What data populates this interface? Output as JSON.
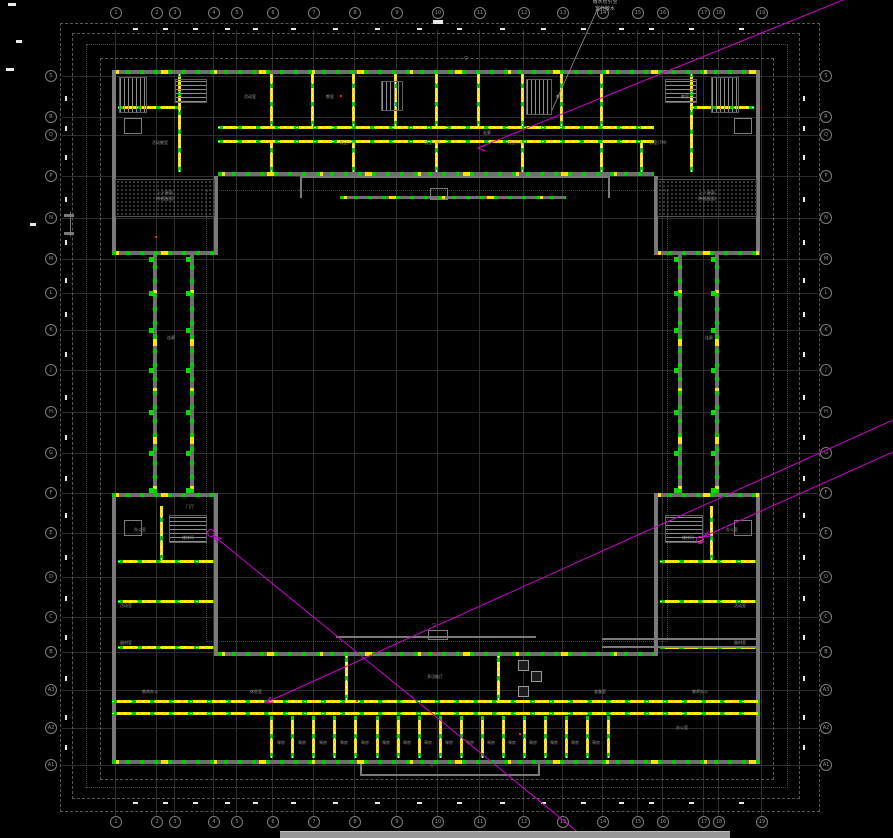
{
  "app": {
    "background": "#000000"
  },
  "colors": {
    "wall": "#7a7a7a",
    "highlight_green": "#00cc00",
    "highlight_yellow": "#ffe400",
    "magenta": "#cf00cf",
    "grid": "#2e2e2e",
    "dim_text": "#e9e9e9",
    "label": "#9a9a9a"
  },
  "bar": {
    "x": 280,
    "y": 831,
    "w": 450,
    "h": 7
  },
  "annotation": {
    "lines": [
      [
        605,
        0,
        "雨水管引至"
      ],
      [
        605,
        7,
        "室外散水"
      ]
    ],
    "leader": [
      597,
      10,
      552,
      110
    ]
  },
  "plan": {
    "grid": {
      "top": 30,
      "bottom": 816,
      "left": 62,
      "right": 818,
      "bub_top": 13,
      "bub_bottom": 822,
      "bub_left": 50,
      "bub_right": 825,
      "cols": [
        {
          "x": 115,
          "l": "1"
        },
        {
          "x": 156,
          "l": "2"
        },
        {
          "x": 174,
          "l": "3"
        },
        {
          "x": 213,
          "l": "4"
        },
        {
          "x": 236,
          "l": "5"
        },
        {
          "x": 272,
          "l": "6"
        },
        {
          "x": 313,
          "l": "7"
        },
        {
          "x": 354,
          "l": "8"
        },
        {
          "x": 396,
          "l": "9"
        },
        {
          "x": 437,
          "l": "10"
        },
        {
          "x": 479,
          "l": "11"
        },
        {
          "x": 523,
          "l": "12"
        },
        {
          "x": 562,
          "l": "13"
        },
        {
          "x": 602,
          "l": "14"
        },
        {
          "x": 637,
          "l": "15"
        },
        {
          "x": 662,
          "l": "16"
        },
        {
          "x": 703,
          "l": "17"
        },
        {
          "x": 718,
          "l": "18"
        },
        {
          "x": 761,
          "l": "19"
        }
      ],
      "rows": [
        {
          "y": 76,
          "l": "S"
        },
        {
          "y": 117,
          "l": "R"
        },
        {
          "y": 135,
          "l": "Q"
        },
        {
          "y": 176,
          "l": "P"
        },
        {
          "y": 218,
          "l": "N"
        },
        {
          "y": 259,
          "l": "M"
        },
        {
          "y": 293,
          "l": "L"
        },
        {
          "y": 330,
          "l": "K"
        },
        {
          "y": 370,
          "l": "J"
        },
        {
          "y": 412,
          "l": "H"
        },
        {
          "y": 453,
          "l": "G"
        },
        {
          "y": 493,
          "l": "F"
        },
        {
          "y": 533,
          "l": "E"
        },
        {
          "y": 577,
          "l": "D"
        },
        {
          "y": 617,
          "l": "C"
        },
        {
          "y": 652,
          "l": "B"
        },
        {
          "y": 690,
          "l": "A3"
        },
        {
          "y": 728,
          "l": "A2"
        },
        {
          "y": 765,
          "l": "A1"
        }
      ]
    },
    "boundaries": [
      [
        "dash",
        60,
        23,
        758,
        787
      ],
      [
        "dash",
        72,
        33,
        726,
        764
      ],
      [
        "dot",
        86,
        44,
        700,
        742
      ],
      [
        "dash",
        100,
        58,
        672,
        720
      ],
      [
        "dot",
        206,
        190,
        460,
        450
      ]
    ],
    "walls": [
      [
        "wt",
        112,
        70,
        648,
        4
      ],
      [
        "w",
        112,
        70,
        4,
        185
      ],
      [
        "w",
        756,
        70,
        4,
        185
      ],
      [
        "hl",
        218,
        126,
        436,
        3
      ],
      [
        "hl",
        218,
        140,
        436,
        3
      ],
      [
        "wt",
        218,
        172,
        436,
        4
      ],
      [
        "wt",
        112,
        251,
        106,
        4
      ],
      [
        "wt",
        654,
        251,
        106,
        4
      ],
      [
        "w",
        214,
        176,
        4,
        79
      ],
      [
        "w",
        654,
        176,
        4,
        79
      ],
      [
        "hl",
        118,
        106,
        62,
        3
      ],
      [
        "hlv",
        178,
        74,
        3,
        98
      ],
      [
        "stv",
        120,
        78,
        26,
        34
      ],
      [
        "st",
        176,
        80,
        30,
        22
      ],
      [
        "hl",
        692,
        106,
        62,
        3
      ],
      [
        "hlv",
        690,
        74,
        3,
        98
      ],
      [
        "stv",
        712,
        78,
        26,
        34
      ],
      [
        "st",
        666,
        80,
        30,
        22
      ],
      [
        "hlv",
        270,
        74,
        3,
        52
      ],
      [
        "hlv",
        311,
        74,
        3,
        52
      ],
      [
        "hlv",
        352,
        74,
        3,
        52
      ],
      [
        "hlv",
        394,
        74,
        3,
        52
      ],
      [
        "hlv",
        435,
        74,
        3,
        52
      ],
      [
        "hlv",
        477,
        74,
        3,
        52
      ],
      [
        "hlv",
        521,
        74,
        3,
        52
      ],
      [
        "hlv",
        560,
        74,
        3,
        52
      ],
      [
        "hlv",
        600,
        74,
        3,
        52
      ],
      [
        "stv",
        527,
        80,
        24,
        34
      ],
      [
        "stv",
        382,
        82,
        20,
        28
      ],
      [
        "hlv",
        270,
        143,
        3,
        29
      ],
      [
        "hlv",
        352,
        143,
        3,
        29
      ],
      [
        "hlv",
        435,
        143,
        3,
        29
      ],
      [
        "hlv",
        521,
        143,
        3,
        29
      ],
      [
        "hlv",
        600,
        143,
        3,
        29
      ],
      [
        "hlv",
        640,
        143,
        3,
        29
      ],
      [
        "w",
        300,
        176,
        310,
        2
      ],
      [
        "wt",
        340,
        196,
        226,
        3
      ],
      [
        "w",
        300,
        176,
        2,
        22
      ],
      [
        "w",
        608,
        176,
        2,
        22
      ],
      [
        "bx",
        430,
        188,
        16,
        10
      ],
      [
        "ht",
        116,
        180,
        98,
        36
      ],
      [
        "ht",
        658,
        180,
        98,
        36
      ],
      [
        "wtv",
        153,
        255,
        4,
        238
      ],
      [
        "wtv",
        190,
        255,
        4,
        238
      ],
      [
        "wtv",
        678,
        255,
        4,
        238
      ],
      [
        "wtv",
        715,
        255,
        4,
        238
      ],
      [
        "w",
        112,
        493,
        4,
        271
      ],
      [
        "w",
        756,
        493,
        4,
        271
      ],
      [
        "wt",
        112,
        493,
        106,
        4
      ],
      [
        "wt",
        654,
        493,
        106,
        4
      ],
      [
        "w",
        214,
        493,
        4,
        163
      ],
      [
        "w",
        654,
        493,
        4,
        163
      ],
      [
        "hl",
        118,
        560,
        96,
        3
      ],
      [
        "hl",
        118,
        600,
        96,
        3
      ],
      [
        "hl",
        118,
        646,
        96,
        3
      ],
      [
        "hlv",
        160,
        506,
        3,
        54
      ],
      [
        "st",
        170,
        516,
        36,
        26
      ],
      [
        "bx",
        124,
        520,
        16,
        14
      ],
      [
        "hl",
        660,
        560,
        96,
        3
      ],
      [
        "hl",
        660,
        600,
        96,
        3
      ],
      [
        "hl",
        660,
        646,
        96,
        3
      ],
      [
        "hlv",
        710,
        506,
        3,
        54
      ],
      [
        "st",
        666,
        516,
        36,
        26
      ],
      [
        "bx",
        734,
        520,
        16,
        14
      ],
      [
        "wt",
        218,
        652,
        436,
        4
      ],
      [
        "hl",
        112,
        700,
        648,
        3
      ],
      [
        "hl",
        112,
        712,
        648,
        3
      ],
      [
        "wt",
        112,
        760,
        648,
        4
      ],
      [
        "hlv",
        345,
        656,
        3,
        44
      ],
      [
        "hlv",
        497,
        656,
        3,
        44
      ],
      [
        "w",
        602,
        638,
        154,
        2
      ],
      [
        "w",
        602,
        646,
        154,
        2
      ],
      [
        "w",
        336,
        636,
        200,
        2
      ],
      [
        "bx",
        428,
        630,
        18,
        8
      ],
      [
        "w",
        360,
        764,
        2,
        12
      ],
      [
        "w",
        538,
        764,
        2,
        12
      ],
      [
        "w",
        360,
        774,
        180,
        2
      ],
      [
        "bx",
        124,
        118,
        16,
        14
      ],
      [
        "bx",
        734,
        118,
        16,
        14
      ],
      [
        "w",
        64,
        214,
        10,
        3
      ],
      [
        "w",
        64,
        232,
        10,
        3
      ],
      [
        "w",
        70,
        212,
        1,
        24
      ],
      [
        "hlv",
        270,
        716,
        3,
        42
      ],
      [
        "hlv",
        291,
        716,
        3,
        42
      ],
      [
        "hlv",
        312,
        716,
        3,
        42
      ],
      [
        "hlv",
        333,
        716,
        3,
        42
      ],
      [
        "hlv",
        354,
        716,
        3,
        42
      ],
      [
        "hlv",
        376,
        716,
        3,
        42
      ],
      [
        "hlv",
        397,
        716,
        3,
        42
      ],
      [
        "hlv",
        418,
        716,
        3,
        42
      ],
      [
        "hlv",
        439,
        716,
        3,
        42
      ],
      [
        "hlv",
        460,
        716,
        3,
        42
      ],
      [
        "hlv",
        481,
        716,
        3,
        42
      ],
      [
        "hlv",
        502,
        716,
        3,
        42
      ],
      [
        "hlv",
        523,
        716,
        3,
        42
      ],
      [
        "hlv",
        544,
        716,
        3,
        42
      ],
      [
        "hlv",
        565,
        716,
        3,
        42
      ],
      [
        "hlv",
        586,
        716,
        3,
        42
      ],
      [
        "hlv",
        607,
        716,
        3,
        42
      ],
      [
        "pil",
        518,
        660,
        9,
        9
      ],
      [
        "pil",
        518,
        686,
        9,
        9
      ],
      [
        "pil",
        531,
        671,
        9,
        9
      ]
    ],
    "columns": {
      "xs": [
        151,
        188,
        676,
        713
      ],
      "ys": [
        259,
        293,
        330,
        370,
        412,
        453,
        490
      ]
    },
    "reds": [
      [
        155,
        236
      ],
      [
        356,
        700
      ],
      [
        519,
        733
      ],
      [
        340,
        95
      ],
      [
        700,
        540
      ],
      [
        434,
        652
      ]
    ],
    "labels": [
      [
        330,
        95,
        "教室"
      ],
      [
        250,
        95,
        "活动室"
      ],
      [
        560,
        95,
        "教室"
      ],
      [
        685,
        95,
        "教室"
      ],
      [
        348,
        141,
        "教室(7M)"
      ],
      [
        433,
        141,
        "教室(7M)"
      ],
      [
        516,
        141,
        "教室(7M)"
      ],
      [
        658,
        141,
        "教室(7M)"
      ],
      [
        160,
        141,
        "活动教室"
      ],
      [
        487,
        131,
        "走廊"
      ],
      [
        165,
        191,
        "上人屋面"
      ],
      [
        165,
        197,
        "(种植屋面)"
      ],
      [
        707,
        191,
        "上人屋面"
      ],
      [
        707,
        197,
        "(种植屋面)"
      ],
      [
        171,
        336,
        "连廊"
      ],
      [
        709,
        336,
        "连廊"
      ],
      [
        140,
        528,
        "办公室"
      ],
      [
        126,
        604,
        "活动室"
      ],
      [
        126,
        641,
        "器材室"
      ],
      [
        188,
        536,
        "楼梯间"
      ],
      [
        150,
        690,
        "教师办公"
      ],
      [
        190,
        505,
        "门厅"
      ],
      [
        732,
        528,
        "办公室"
      ],
      [
        740,
        604,
        "活动室"
      ],
      [
        740,
        641,
        "器材室"
      ],
      [
        688,
        536,
        "楼梯间"
      ],
      [
        700,
        690,
        "教师办公"
      ],
      [
        435,
        675,
        "多功能厅"
      ],
      [
        682,
        726,
        "办公室"
      ],
      [
        256,
        690,
        "休息室"
      ],
      [
        600,
        690,
        "准备室"
      ]
    ],
    "level_marks": [
      [
        466,
        57,
        "▽"
      ],
      [
        664,
        561,
        "▽"
      ],
      [
        434,
        624,
        "▽"
      ],
      [
        432,
        764,
        "▽"
      ]
    ],
    "repeat_labels": {
      "t": "琴房",
      "y": 741,
      "xs": [
        281,
        302,
        323,
        344,
        365,
        386,
        407,
        428,
        449,
        470,
        491,
        512,
        533,
        554,
        575,
        596
      ]
    },
    "dims": {
      "top": {
        "y": 28,
        "xs": [
          133,
          163,
          193,
          225,
          253,
          291,
          333,
          375,
          417,
          457,
          500,
          541,
          581,
          619,
          649,
          689,
          739
        ]
      },
      "bottom": {
        "y": 802,
        "xs": [
          133,
          163,
          193,
          225,
          253,
          291,
          333,
          375,
          417,
          457,
          500,
          541,
          581,
          619,
          649,
          689,
          739
        ]
      },
      "left": {
        "x": 65,
        "ys": [
          96,
          126,
          155,
          197,
          240,
          278,
          312,
          352,
          395,
          435,
          476,
          513,
          555,
          596,
          635,
          676,
          715,
          745
        ]
      },
      "right": {
        "x": 803,
        "ys": [
          96,
          126,
          155,
          197,
          240,
          278,
          312,
          352,
          395,
          435,
          476,
          513,
          555,
          596,
          635,
          676,
          715,
          745
        ]
      },
      "misc": [
        [
          8,
          3,
          8,
          3
        ],
        [
          16,
          40,
          6,
          3
        ],
        [
          6,
          68,
          8,
          3
        ],
        [
          30,
          223,
          6,
          3
        ],
        [
          433,
          20,
          10,
          4
        ]
      ]
    },
    "magenta": {
      "lines": [
        [
          843,
          0,
          478,
          148
        ],
        [
          893,
          420,
          265,
          703
        ],
        [
          893,
          452,
          703,
          537
        ],
        [
          214,
          536,
          585,
          838
        ]
      ],
      "arrows": [
        [
          478,
          148,
          486,
          151,
          487,
          144
        ],
        [
          265,
          703,
          274,
          702,
          271,
          697
        ],
        [
          703,
          537,
          712,
          536,
          709,
          531
        ],
        [
          214,
          536,
          222,
          539,
          218,
          543
        ]
      ],
      "circles": [
        [
          700,
          540
        ],
        [
          211,
          533
        ]
      ]
    }
  }
}
